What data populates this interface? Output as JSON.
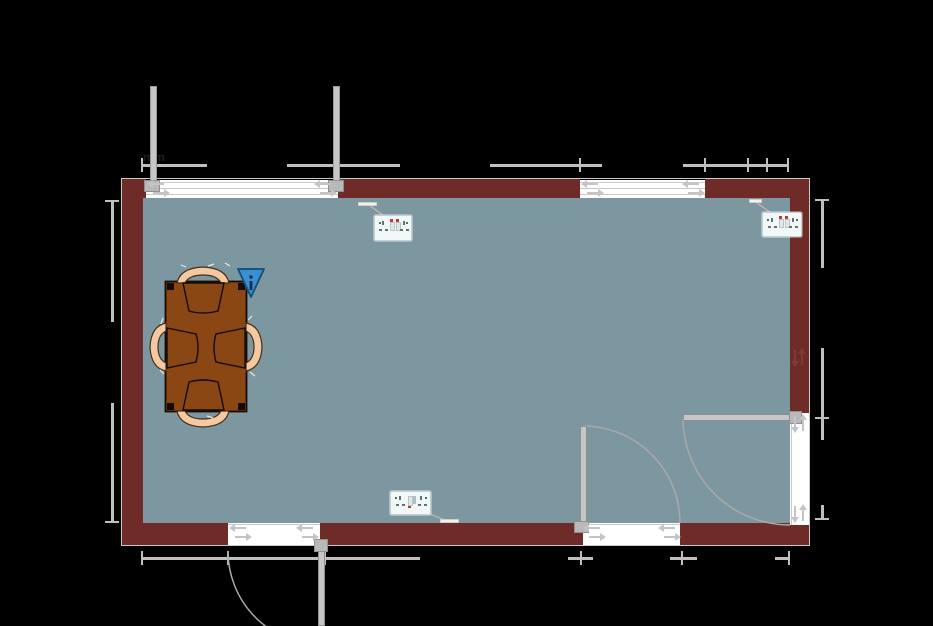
{
  "app": {
    "type": "floor-plan-canvas",
    "background": "#000000"
  },
  "colors": {
    "background": "#000000",
    "wall": "#6E2B28",
    "floor": "#7D97A1",
    "frame": "#C9C9C9",
    "dimension": "#BFBFBF",
    "fixture": "#C4C4C4",
    "table": "#8A4613",
    "table_outline": "#140A04",
    "chair": "#F2C9A2",
    "chair_outline": "#4A2E12",
    "marker_blue": "#3A8FD0",
    "marker_border": "#18527F",
    "arc": "#A9A9A9",
    "leader": "#C9B6B2",
    "socket_body": "#F2F7F7",
    "socket_red": "#C03A30",
    "socket_pin": "#5E7474",
    "socket_green": "#3F7750"
  },
  "annotations": {
    "partial_dimension_text": "mm"
  },
  "room": {
    "walls": [
      {
        "id": "top-wall"
      },
      {
        "id": "left-wall"
      },
      {
        "id": "right-wall"
      },
      {
        "id": "bottom-wall"
      }
    ],
    "windows": [
      {
        "id": "window-top-left",
        "style": "double-leaf, leaves open outward"
      },
      {
        "id": "window-top-right",
        "style": "sliding arrows"
      }
    ],
    "doors": [
      {
        "id": "door-bottom-left-exterior",
        "swing": "outward"
      },
      {
        "id": "door-interior-bottom",
        "swing": "into room"
      },
      {
        "id": "door-interior-right",
        "swing": "into room"
      }
    ]
  },
  "furniture": {
    "table": {
      "label": "rectangular dining table"
    },
    "chairs": [
      {
        "position": "top"
      },
      {
        "position": "left"
      },
      {
        "position": "right"
      },
      {
        "position": "bottom"
      }
    ],
    "marker": {
      "type": "warning-triangle-indicator"
    },
    "sockets": [
      {
        "id": "double-socket-top-left",
        "mounted": "top wall"
      },
      {
        "id": "double-socket-top-right",
        "mounted": "top wall near right corner"
      },
      {
        "id": "double-socket-bottom",
        "mounted": "bottom wall"
      }
    ]
  },
  "icons": [
    "sliding-arrow-icon",
    "door-swing-arc",
    "dimension-tick",
    "warning-triangle-icon",
    "socket-face-icon"
  ]
}
